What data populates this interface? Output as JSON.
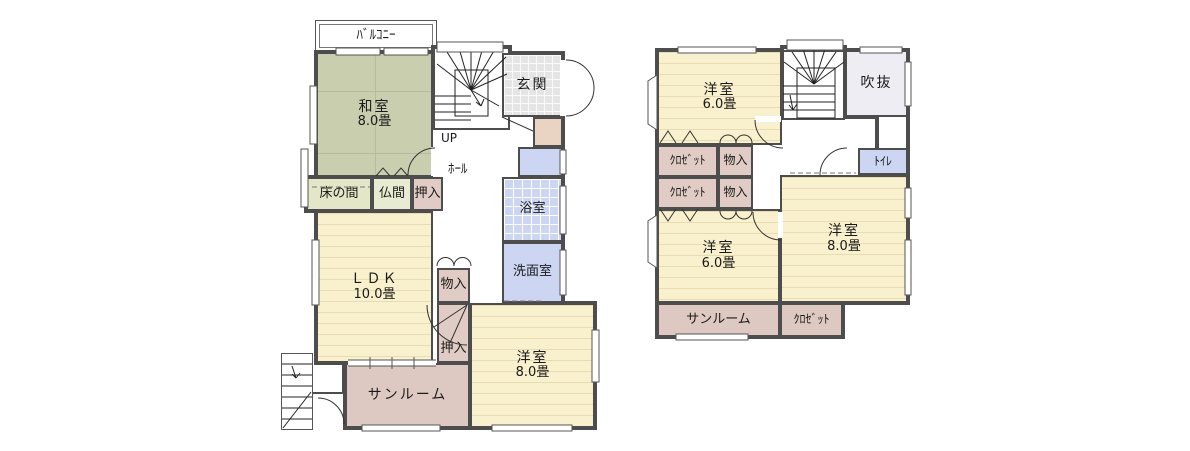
{
  "colors": {
    "wall": "#4d4d4d",
    "tatami_green": "#c9cfae",
    "wood_cream": "#f9f0cd",
    "closet_pink": "#e0ccc4",
    "water_blue": "#ccd6f2",
    "entrance_tile": "#e5e5e5",
    "void_gray": "#ededf3"
  },
  "floor1": {
    "balcony": "ﾊﾞﾙｺﾆｰ",
    "washitsu": "和室",
    "washitsu_size": "8.0畳",
    "up": "UP",
    "genkan": "玄関",
    "hall": "ﾎｰﾙ",
    "tokonoma": "床の間",
    "butsuma": "仏間",
    "oshiire_upper": "押入",
    "bath": "浴室",
    "washroom": "洗面室",
    "ldk": "ＬＤＫ",
    "ldk_size": "10.0畳",
    "monoire": "物入",
    "oshiire_lower": "押入",
    "yoshitsu": "洋室",
    "yoshitsu_size": "8.0畳",
    "sunroom": "サンルーム"
  },
  "floor2": {
    "yoshitsu_top": "洋室",
    "yoshitsu_top_size": "6.0畳",
    "void": "吹抜",
    "closet_row1": "ｸﾛｾﾞｯﾄ",
    "monoire_row1": "物入",
    "closet_row2": "ｸﾛｾﾞｯﾄ",
    "monoire_row2": "物入",
    "toilet": "ﾄｲﾚ",
    "yoshitsu_mid": "洋室",
    "yoshitsu_mid_size": "6.0畳",
    "yoshitsu_right": "洋室",
    "yoshitsu_right_size": "8.0畳",
    "sunroom": "サンルーム",
    "closet_bottom": "ｸﾛｾﾞｯﾄ"
  }
}
